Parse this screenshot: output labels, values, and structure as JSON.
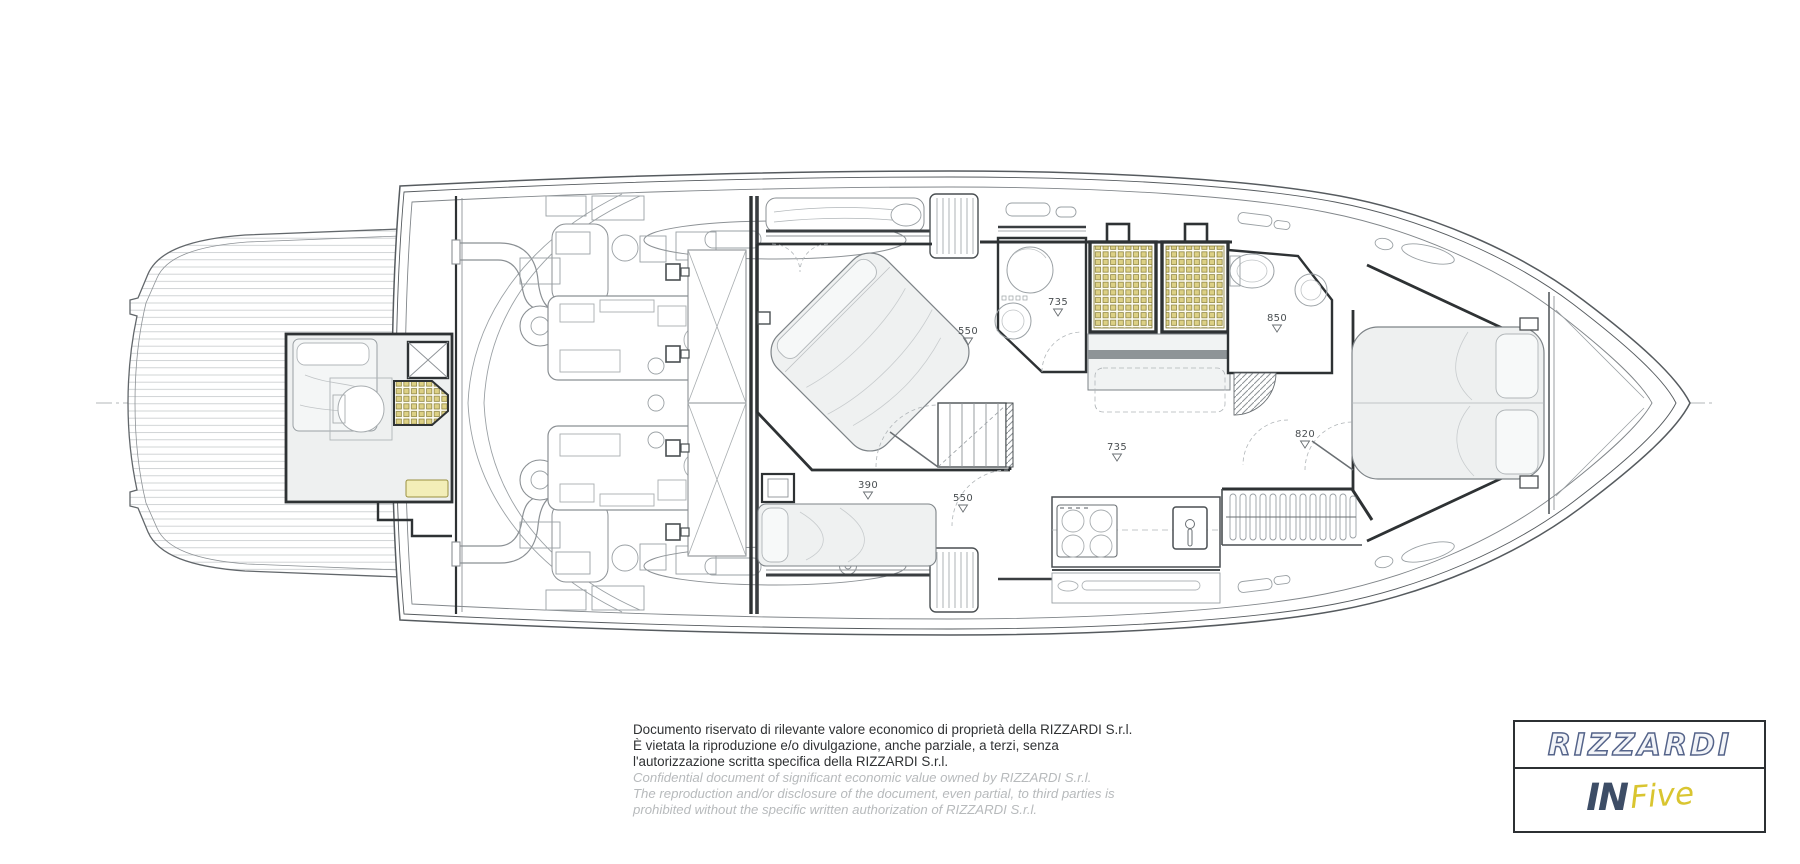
{
  "plan": {
    "level_markers": [
      {
        "value": "550"
      },
      {
        "value": "735"
      },
      {
        "value": "850"
      },
      {
        "value": "820"
      },
      {
        "value": "735"
      },
      {
        "value": "390"
      },
      {
        "value": "550"
      }
    ]
  },
  "notice": {
    "italian": [
      "Documento riservato di rilevante valore economico di proprietà della RIZZARDI S.r.l.",
      "È vietata la riproduzione e/o divulgazione, anche parziale, a terzi, senza",
      "l'autorizzazione scritta specifica della RIZZARDI S.r.l."
    ],
    "english": [
      "Confidential document of significant economic value owned by RIZZARDI S.r.l.",
      "The reproduction and/or disclosure of the document, even partial, to third parties is",
      "prohibited without the specific written authorization of RIZZARDI S.r.l."
    ]
  },
  "logo": {
    "brand": "RIZZARDI",
    "model_prefix": "IN",
    "model_name": "Five"
  },
  "colors": {
    "accent_yellow": "#ddd189",
    "line_dark": "#2e3234",
    "line_mid": "#6a6f73",
    "logo_navy": "#3d4d66",
    "logo_yellow": "#d9c530"
  }
}
